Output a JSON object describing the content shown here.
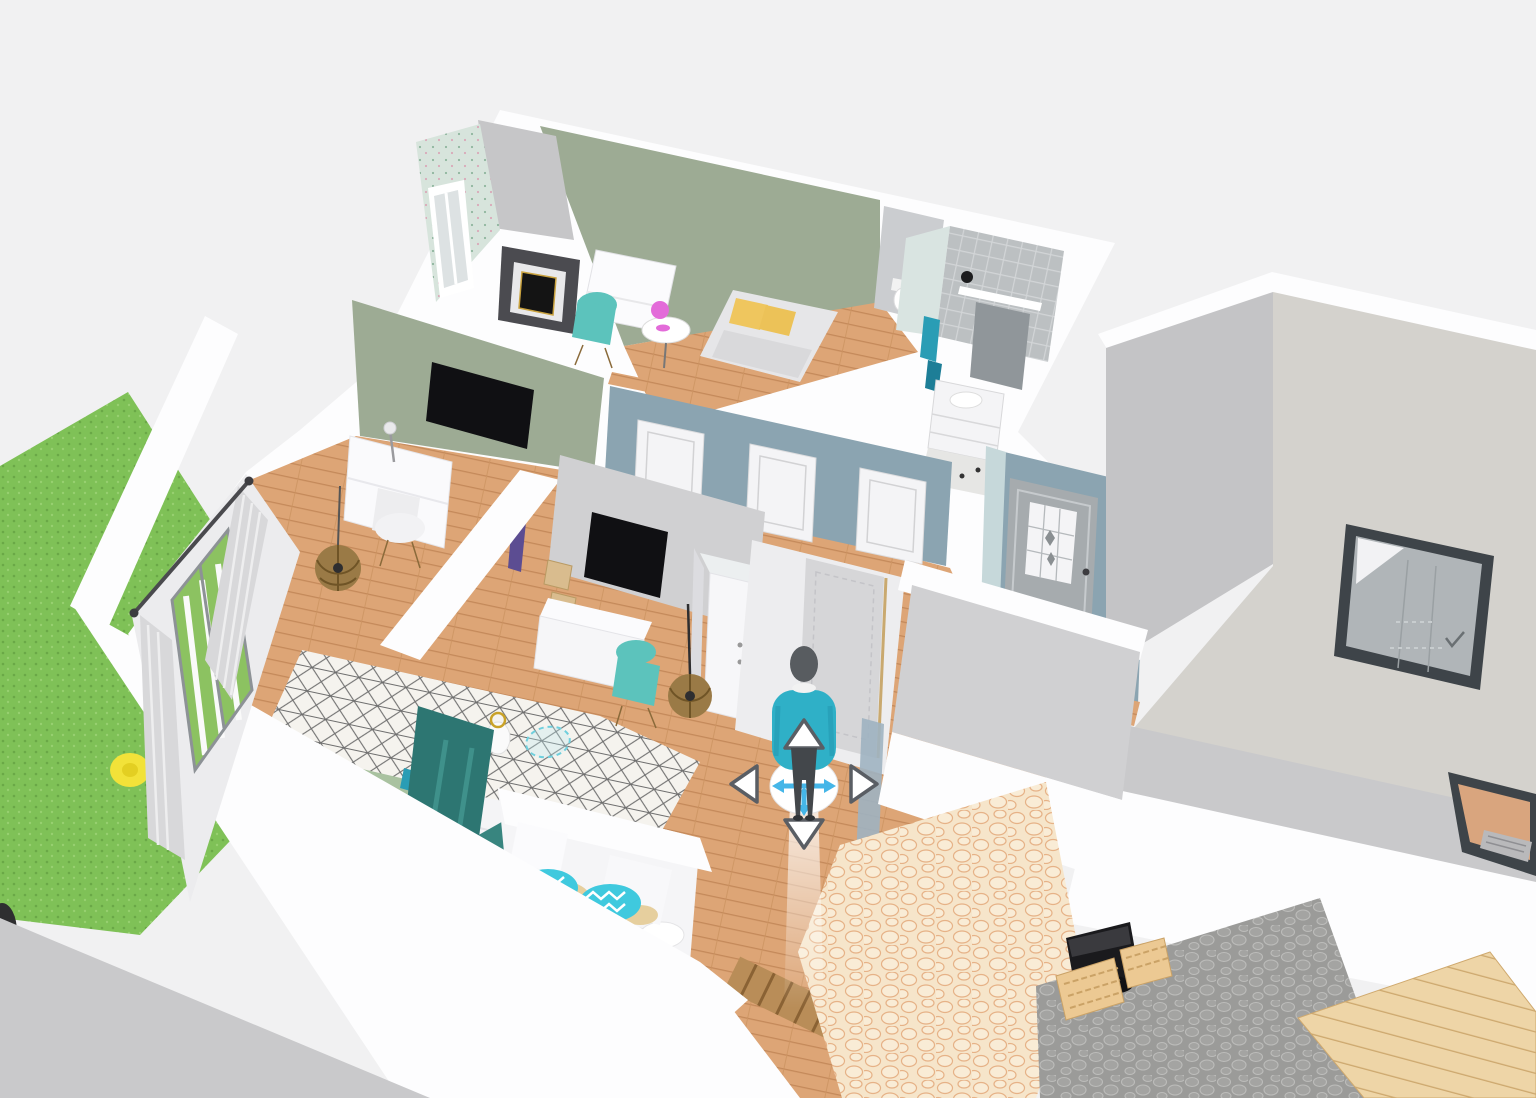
{
  "app": {
    "viewport": "3d-floorplan-first-person-view",
    "visible_text": []
  },
  "palette": {
    "bg": "#f1f1f2",
    "wall": "#fdfdfe",
    "wallShade": "#c9c9cb",
    "wallFace": "#d2d2d4",
    "sage": "#9dab94",
    "wood": "#dda576",
    "woodLine": "#c4895a",
    "slate": "#8ba4b1",
    "paleBlue": "#c6d8da",
    "grass": "#7fc157",
    "rugBase": "#f5f3ee",
    "rugLine": "#6e6e6e",
    "tealDark": "#2e7b76",
    "tealLight": "#3fc9de",
    "tealChair": "#5cc3bc",
    "yellow": "#efc65e",
    "pink": "#e36bd9",
    "avatarShirt": "#2fb0c7",
    "avatarDark": "#43474b",
    "navBlue": "#45b6e8",
    "navBorder": "#5a5e64",
    "tvBlack": "#101013",
    "stone": "#9b9b99",
    "cobbleBase": "#f6e5ca",
    "cobbleLine": "#e6b287",
    "tableWood": "#eed5a7",
    "tableLine": "#cda86e",
    "grill": "#1a1a1d",
    "mirrorFrame": "#3e4449",
    "mirrorGlass": "#b0b5b8",
    "floorBeige": "#d4d2cd",
    "tile": "#bcc0c2",
    "parasol": "#f2e239",
    "rattan": "#9a7a46"
  },
  "controls": {
    "viewport": "rotate-pan-3d-scene",
    "avatar": "avatar-figure",
    "joystick": "move-joystick",
    "arrow_up": "walk-forward-arrow",
    "arrow_down": "walk-backward-arrow",
    "arrow_left": "strafe-left-arrow",
    "arrow_right": "strafe-right-arrow"
  },
  "scene_objects": [
    "garden-grass",
    "garden-parasol",
    "curtained-window",
    "bedroom-fireplace",
    "bedroom-desk",
    "bedroom-bed-yellow-pillows",
    "wallpaper-wall",
    "wall-tv",
    "office-desk",
    "rattan-pendant",
    "toilet",
    "bathroom-mirror",
    "bathroom-vanity",
    "towels",
    "hallway-doors",
    "front-door",
    "entry-doormat",
    "wardrobe",
    "kids-desk",
    "kids-bed",
    "teal-wardrobe-panel",
    "sofa-chevron-pillows",
    "trellis-rug",
    "wall-mirror-large",
    "patio-stones",
    "cobblestone-path",
    "bbq-grill",
    "wooden-chairs",
    "wooden-table",
    "fireplace-niche"
  ]
}
